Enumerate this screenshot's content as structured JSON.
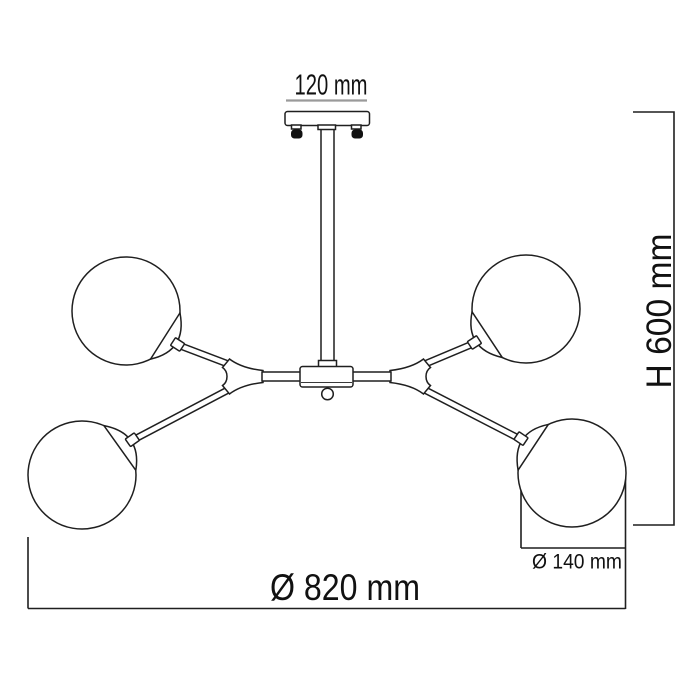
{
  "drawing": {
    "type": "technical dimension drawing",
    "subject": "four-globe ceiling chandelier, side view"
  },
  "dimensions": {
    "canopy_width": "120 mm",
    "height": "H 600 mm",
    "total_diameter": "Ø 820 mm",
    "globe_diameter": "Ø 140 mm"
  },
  "colors": {
    "line": "#1f1f1f",
    "canopy_dim_line": "#9a9a9a",
    "screw": "#111111",
    "background": "#ffffff"
  }
}
